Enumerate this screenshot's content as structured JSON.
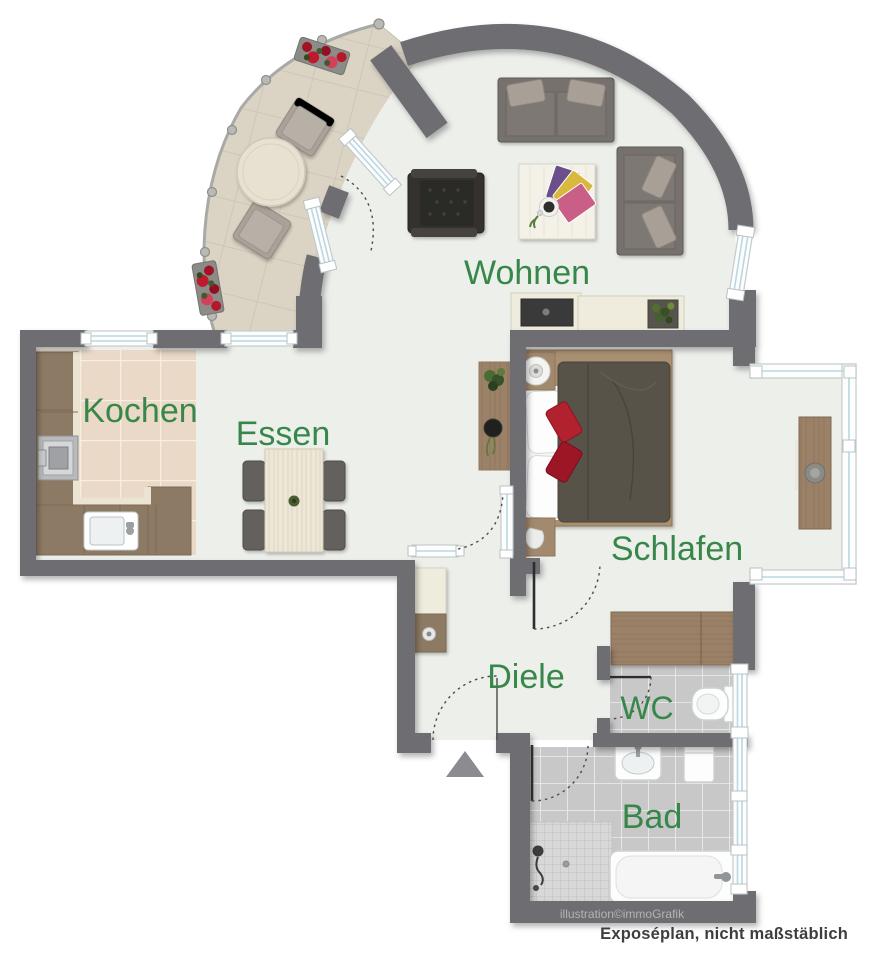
{
  "rooms": {
    "wohnen": {
      "label": "Wohnen"
    },
    "kochen": {
      "label": "Kochen"
    },
    "essen": {
      "label": "Essen"
    },
    "schlafen": {
      "label": "Schlafen"
    },
    "diele": {
      "label": "Diele"
    },
    "wc": {
      "label": "WC"
    },
    "bad": {
      "label": "Bad"
    }
  },
  "annotations": {
    "watermark": "illustration©immoGrafik",
    "caption": "Exposéplan, nicht maßstäblich"
  },
  "icons": {
    "entrance_arrow": "triangle-up",
    "door_swing": "dotted-quarter-arc"
  },
  "colors": {
    "wall": "#6d6d72",
    "floor": "#edefeb",
    "green": "#37874a",
    "glass": "#b9d8e2",
    "wood": "#9b8168",
    "counter": "#8d7a64",
    "sofa": "#76716d",
    "cushion": "#a8a096",
    "duvet": "#585248",
    "red": "#b1202e",
    "caption": "#3e3e3e",
    "watermark": "#b4b4b4"
  }
}
